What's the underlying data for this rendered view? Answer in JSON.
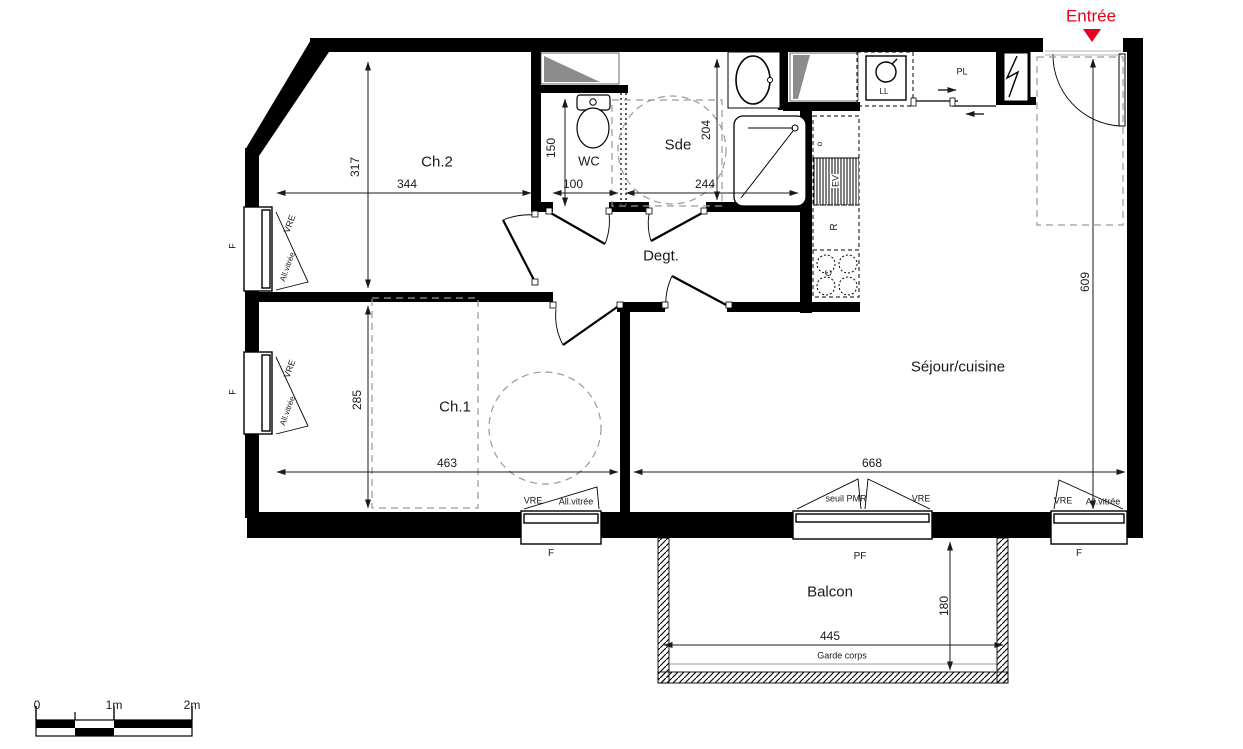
{
  "entrance": {
    "label": "Entrée"
  },
  "rooms": {
    "ch2": "Ch.2",
    "wc": "WC",
    "sde": "Sde",
    "degt": "Degt.",
    "sejour": "Séjour/cuisine",
    "ch1": "Ch.1",
    "balcon": "Balcon"
  },
  "dims": {
    "d344": "344",
    "d100": "100",
    "d244": "244",
    "d317": "317",
    "d150": "150",
    "d204": "204",
    "d285": "285",
    "d463": "463",
    "d668": "668",
    "d609": "609",
    "d180": "180",
    "d445": "445"
  },
  "labels": {
    "vre": "VRE",
    "all_vitree": "All.vitrée",
    "f": "F",
    "pf": "PF",
    "seuil_pmr": "seuil PMR",
    "garde_corps": "Garde corps",
    "pl": "PL",
    "ll": "LL",
    "ev": "EV",
    "r": "R",
    "c": "C",
    "o": "o"
  },
  "scale_bar": {
    "zero": "0",
    "one": "1m",
    "two": "2m"
  },
  "colors": {
    "entrance_red": "#e8001c",
    "wall": "#000000",
    "duct": "#8c8c8c"
  }
}
